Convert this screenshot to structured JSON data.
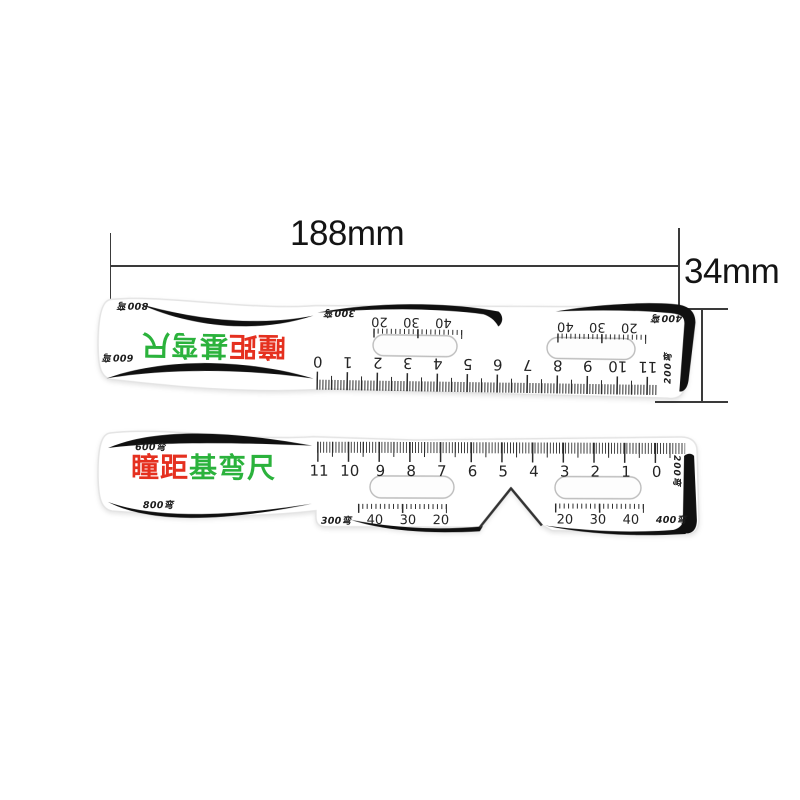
{
  "palette": {
    "red": "#e5301f",
    "green": "#2bb23c",
    "ink": "#2b2b2b",
    "black": "#101010",
    "dim_line": "#3a3a3a",
    "dim_text": "#141414"
  },
  "annotations": {
    "width_label": "188mm",
    "height_label": "34mm"
  },
  "back_ruler": {
    "label_top_left": "800弯",
    "label_bottom_left": "600弯",
    "title_red": "瞳距",
    "title_green": "基弯尺",
    "label_300": "300弯",
    "label_400": "400弯",
    "label_200": "200弯",
    "main_numbers": [
      "0",
      "1",
      "2",
      "3",
      "4",
      "5",
      "6",
      "7",
      "8",
      "9",
      "10",
      "11"
    ],
    "left_eye_numbers": [
      "20",
      "30",
      "40"
    ],
    "right_eye_numbers": [
      "40",
      "30",
      "20"
    ]
  },
  "front_ruler": {
    "label_top_left": "600弯",
    "label_bottom_left": "800弯",
    "title_red": "瞳距",
    "title_green": "基弯尺",
    "label_300": "300弯",
    "label_400": "400弯",
    "label_200": "200弯",
    "main_numbers": [
      "11",
      "10",
      "9",
      "8",
      "7",
      "6",
      "5",
      "4",
      "3",
      "2",
      "1",
      "0"
    ],
    "left_eye_numbers": [
      "40",
      "30",
      "20"
    ],
    "right_eye_numbers": [
      "20",
      "30",
      "40"
    ]
  }
}
